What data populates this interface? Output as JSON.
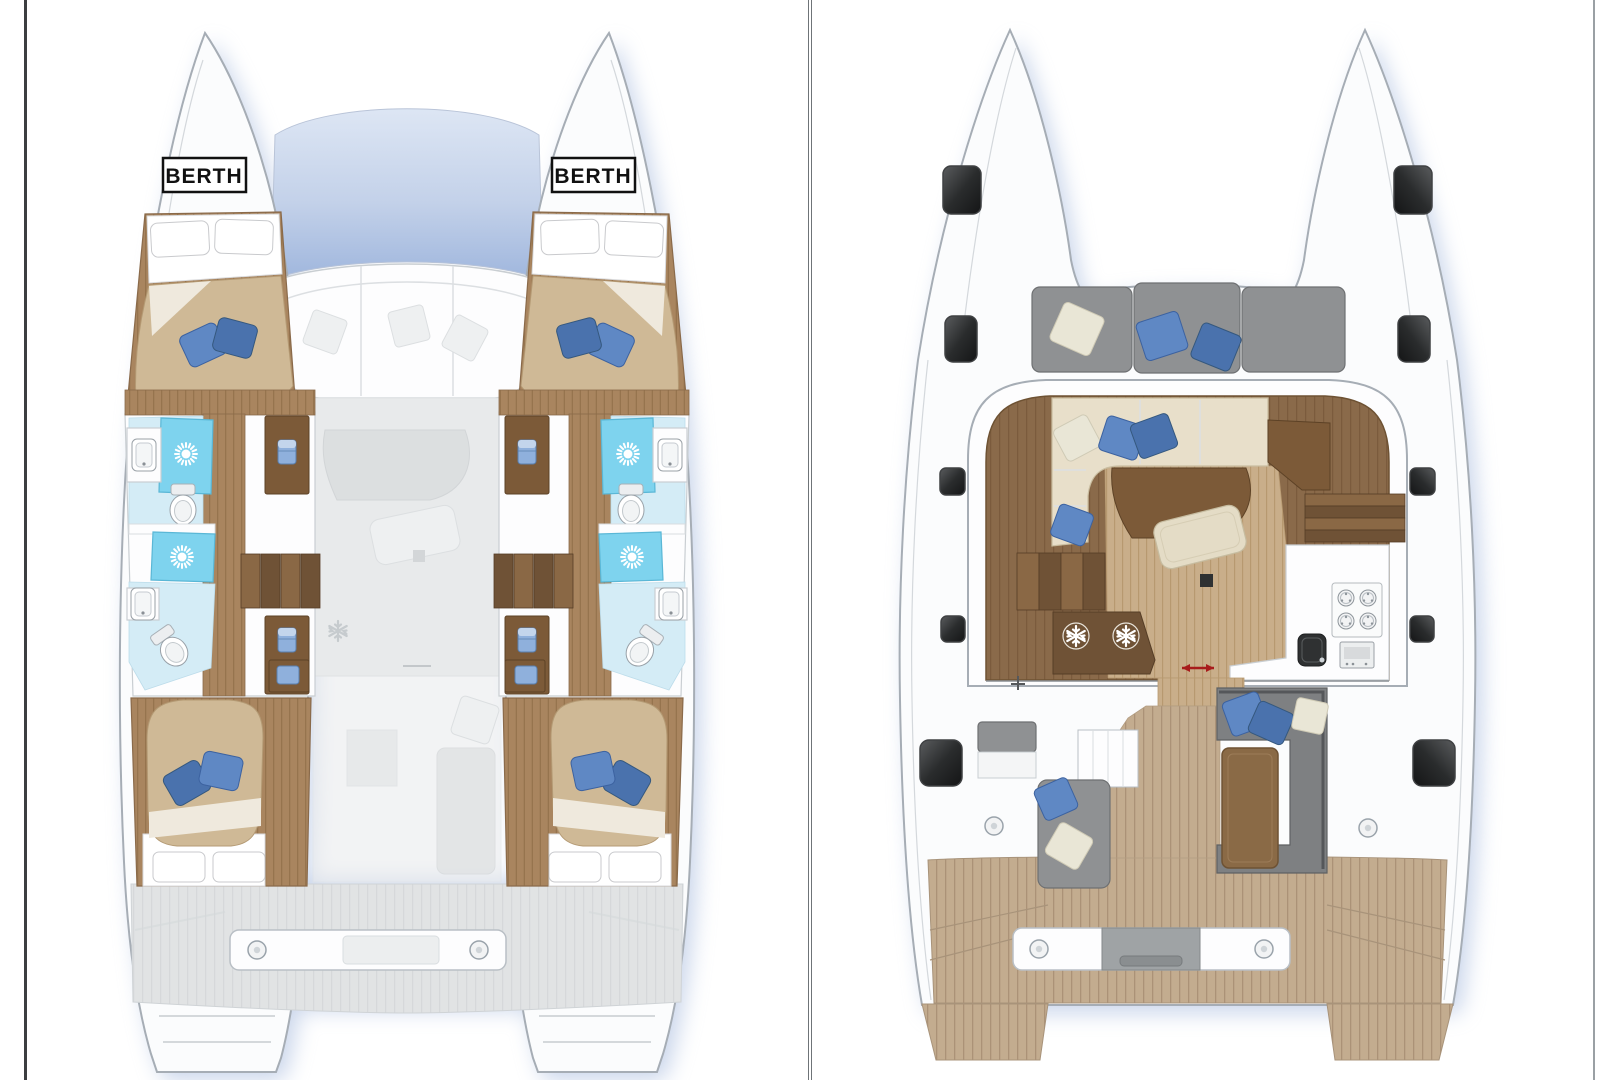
{
  "page": {
    "background": "#ffffff"
  },
  "palette": {
    "pageBg": "#ffffff",
    "frameDark": "#3c3e40",
    "frameMid": "#6f7478",
    "frameLight": "#9aa0a4",
    "hull": "#fbfcfd",
    "hullStroke": "#a6adb5",
    "glow": "#93abd6",
    "windowTop": "#dde6f4",
    "windowBottom": "#9fb6dd",
    "woodCabin": "#a9855f",
    "woodLight": "#c9ae8a",
    "woodDark": "#7c5a38",
    "stairLight": "#8a6845",
    "stairDark": "#6f5236",
    "mattress": "#cfb996",
    "sheet": "#ffffff",
    "pillowBlue": "#5f88c4",
    "pillowBlueDark": "#4a72ad",
    "pillowCream": "#e9e6d6",
    "showerBlue": "#7ed3ee",
    "tileBlue": "#d4ecf6",
    "ghost": "#e8eaeb",
    "deckGray": "#e1e3e4",
    "benchGray": "#8f9193",
    "benchGrayDark": "#6e7072",
    "deckTeak": "#c3ac8f",
    "salonFloor": "#8a6a4a",
    "sofaCream": "#e8dfca",
    "hatchDark": "#2a2c2d",
    "accentRed": "#a81c1c",
    "labelInk": "#111111"
  },
  "left_panel": {
    "name": "accommodation-deck-plan",
    "berth_label_port": "BERTH",
    "berth_label_starboard": "BERTH",
    "icon_legend": {
      "shower-icon": "sunburst",
      "toilet-icon": "oval-bowl",
      "sink-icon": "basin",
      "wardrobe-icon": "folded-clothes",
      "fridge-icon": "snowflake",
      "deck-fitting-icon": "ringed-circle"
    }
  },
  "right_panel": {
    "name": "main-deck-plan",
    "icon_legend": {
      "hatch-icon": "dark-rounded-square",
      "stove-icon": "four-burner-hob",
      "oven-icon": "oven-door",
      "sink-icon": "dark-basin",
      "fridge-icon": "snowflake",
      "door-slide-icon": "red-double-arrow",
      "deck-fitting-icon": "ringed-circle",
      "mast-icon": "cross-mark"
    }
  }
}
